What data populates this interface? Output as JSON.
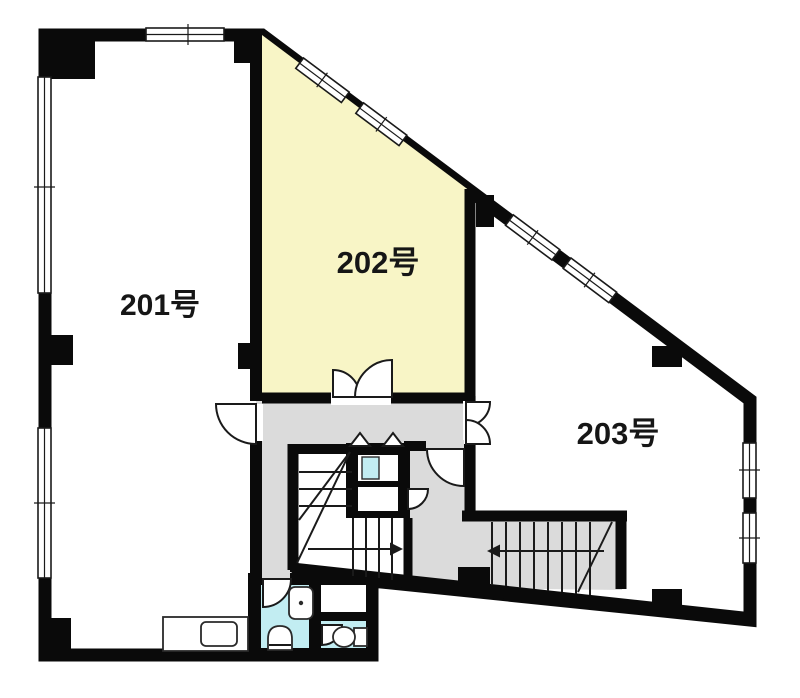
{
  "plan": {
    "background": "#ffffff",
    "wall_color": "#0a0a0a",
    "rooms": [
      {
        "id": "201",
        "label": "201号",
        "fill": "#ffffff",
        "highlighted": false
      },
      {
        "id": "202",
        "label": "202号",
        "fill": "#f8f5c6",
        "highlighted": true
      },
      {
        "id": "203",
        "label": "203号",
        "fill": "#ffffff",
        "highlighted": false
      }
    ],
    "zones": {
      "corridor_fill": "#dbdbdb",
      "stair_fill": "#ffffff",
      "wet_area_fill": "#c2edf2"
    },
    "stairs": [
      {
        "id": "center-stair",
        "arrow_direction": "right"
      },
      {
        "id": "room203-stair",
        "arrow_direction": "left"
      }
    ]
  }
}
